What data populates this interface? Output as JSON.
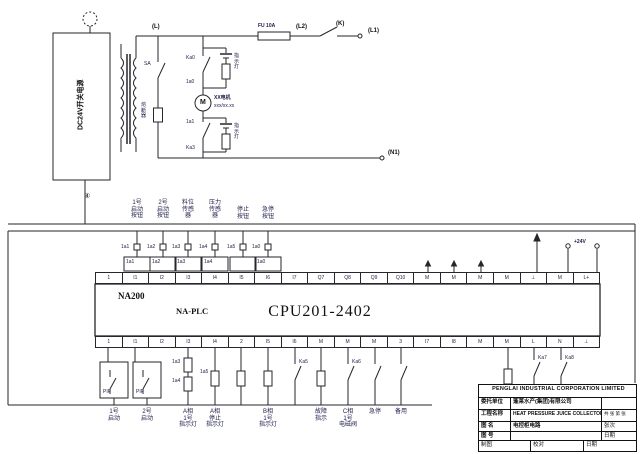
{
  "diagram": {
    "power": {
      "psu_label": "DC24V开关电源",
      "node_l": "(L)",
      "fuse_label": "FU 10A",
      "node_l2": "(L2)",
      "node_k": "(K)",
      "node_l1": "(L1)",
      "node_n1": "(N1)",
      "node_4": "④",
      "sa_tag": "SA",
      "sa_device": "熔\n断\n器",
      "lamp1_tag_top": "Ka0",
      "lamp1_tag_bot": "1a0",
      "lamp1_name": "指\n示\n灯",
      "lamp2_tag_top": "1a1",
      "lamp2_tag_bot": "Ka3",
      "lamp2_name": "指\n示\n灯",
      "motor_symbol": "M",
      "motor_name": "XX电机",
      "motor_rating": "xxx/xx.xx",
      "plus24v": "+24V"
    },
    "inputs": {
      "columns": [
        "1号\n启动\n按钮",
        "2号\n启动\n按钮",
        "料位\n传感\n器",
        "压力\n传感\n器",
        "停止\n按钮",
        "急停\n按钮"
      ],
      "contact_tags": [
        "1a1",
        "1a2",
        "1a3",
        "1a4",
        "1a5",
        "1a0"
      ],
      "terminal_tags": [
        "1a1",
        "1a2",
        "1a3",
        "1a4",
        "1a0"
      ]
    },
    "plc": {
      "brand": "NA200",
      "family": "NA-PLC",
      "cpu": "CPU201-2402",
      "top_terminals": [
        "1",
        "I1",
        "I2",
        "I3",
        "I4",
        "I5",
        "I6",
        "I7",
        "Q7",
        "Q8",
        "Q9",
        "Q10",
        "M",
        "M",
        "M",
        "M",
        "⊥",
        "M",
        "L+"
      ],
      "bottom_terminals": [
        "1",
        "I1",
        "I2",
        "I3",
        "I4",
        "2",
        "I5",
        "I6",
        "M",
        "M",
        "M",
        "3",
        "I7",
        "I8",
        "M",
        "M",
        "L",
        "N",
        "⊥"
      ]
    },
    "outputs": {
      "relay1_label": "PIF",
      "relay2_label": "PIF",
      "coil_tags": [
        "1a3",
        "1a4",
        "1a5"
      ],
      "contact_tags": [
        "Ka5",
        "Ka6",
        "Ka7",
        "Ka8"
      ],
      "labels": [
        "1号\n启动",
        "2号\n启动",
        "A相\n1号\n指示灯",
        "A相\n停止\n指示灯",
        "B相\n1号\n指示灯",
        "故障\n指示",
        "C相\n1号\n电磁阀",
        "急停",
        "备用"
      ]
    },
    "titleblock": {
      "company": "PENGLAI INDUSTRIAL CORPORATION LIMITED",
      "client_label": "委托单位",
      "client_value": "蓬莱水产(集团)有限公司",
      "project_label": "工程名称",
      "project_value": "HEAT PRESSURE JUICE COLLECTOR",
      "project_extra": "共 张 第 张",
      "drawing_label": "图 名",
      "drawing_value": "电控柜电路",
      "drawing_extra": "张次",
      "number_label": "图 号",
      "number_value": "",
      "number_extra": "日期",
      "sign_left": "制图",
      "sign_mid": "校对",
      "sign_right": "日期"
    }
  }
}
